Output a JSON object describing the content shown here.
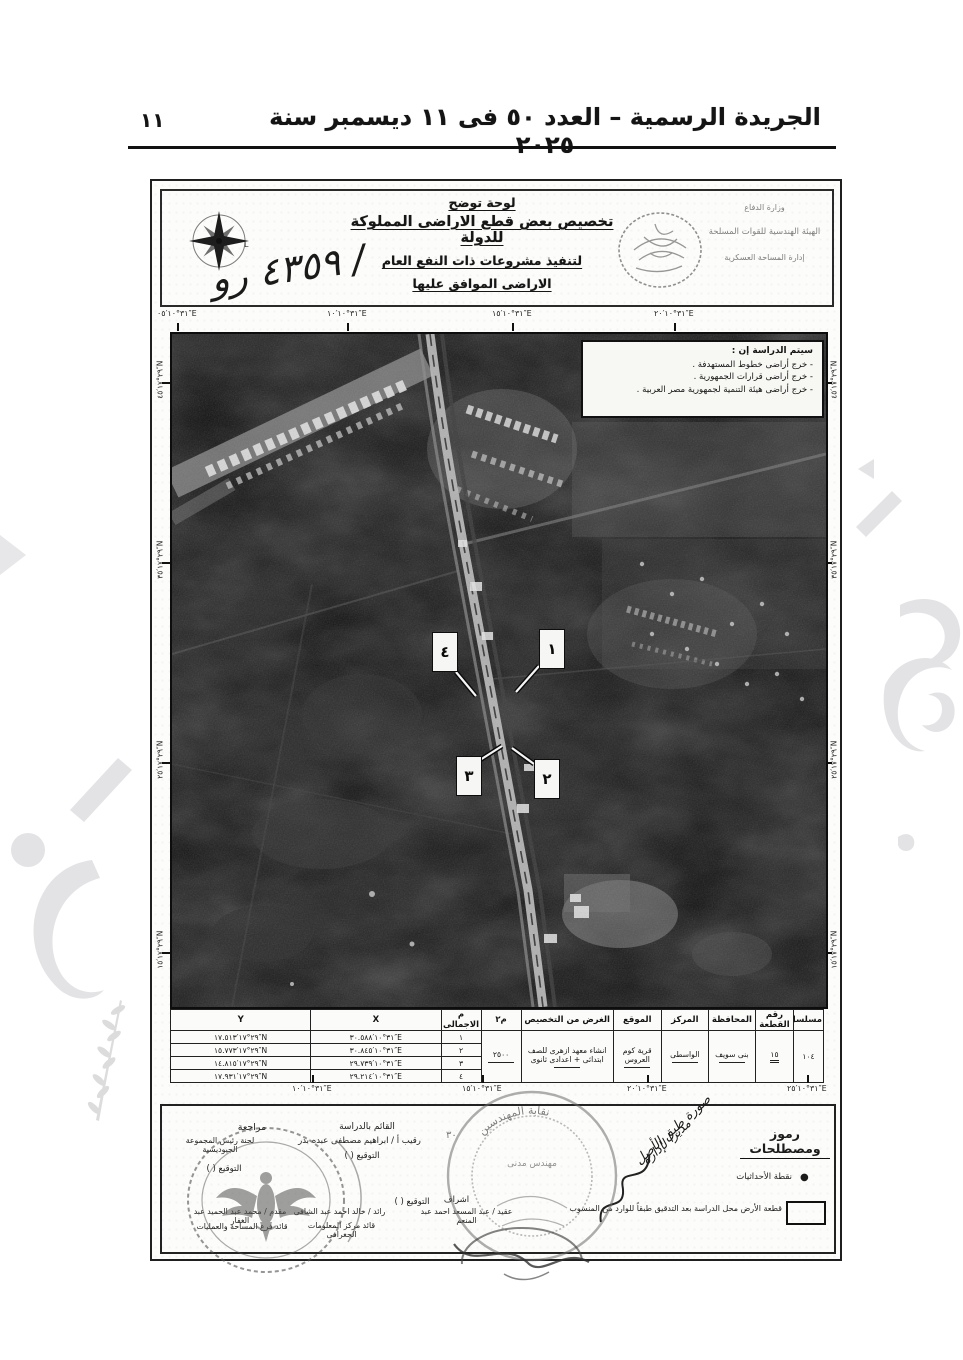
{
  "page": {
    "number": "١١",
    "header": "الجريدة الرسمية – العدد ٥٠ فى ١١ ديسمبر سنة ٢٠٢٥"
  },
  "plate": {
    "heading1": "لوحة توضح",
    "heading2": "تخصيص بعض قطع الاراضى المملوكة للدولة",
    "heading3": "لتنفيذ مشروعات ذات النفع العام",
    "heading4": "الاراضى الموافق عليها",
    "agency1": "وزارة الدفاع",
    "agency2": "الهيئة الهندسية للقوات المسلحة",
    "agency3": "إدارة المساحة العسكرية",
    "handwritten_number": "٤٣٥٩ رو /",
    "compass_letter": "L"
  },
  "map": {
    "legend_heading": "سيتم الدراسة إن :",
    "legend_item1": "- خرج أراضى خطوط المستهدفة .",
    "legend_item2": "- خرج أراضى قرارات الجمهورية .",
    "legend_item3": "- خرج أراضى هيئة التنمية لجمهورية مصر العربية .",
    "callout1": "١",
    "callout2": "٢",
    "callout3": "٣",
    "callout4": "٤",
    "coords_lon_top": [
      "٣١°١٠′٠٥″E",
      "٣١°١٠′١٠″E",
      "٣١°١٠′١٥″E",
      "٣١°١٠′٢٠″E"
    ],
    "coords_lon_bottom": [
      "٣١°١٠′١٠″E",
      "٣١°١٠′١٥″E",
      "٣١°١٠′٢٠″E",
      "٣١°١٠′٢٥″E"
    ],
    "coords_lat": [
      "٢٩°١٧′٤٥″N",
      "٢٩°١٧′٣٥″N",
      "٢٩°١٧′٢٥″N",
      "٢٩°١٧′١٥″N"
    ]
  },
  "table": {
    "headers": [
      "مسلسل",
      "رقم القطعة",
      "المحافظة",
      "المركز",
      "الموقع",
      "الغرض من التخصيص",
      "م٢",
      "م الاجمالى",
      "X",
      "Y"
    ],
    "serial": "١٠٤",
    "plot_no": "١٥",
    "governorate": "بنى سويف",
    "center": "الواسطى",
    "location": "قرية كوم العروس",
    "purpose": "انشاء معهد ازهرى للصف ابتدائى + اعدادى ثانوى",
    "area_m2": "٢٥٠٠",
    "points": [
      {
        "no": "١",
        "x": "٣١°١٠′٣٠.٥٨٨″E",
        "y": "٢٩°١٧′١٧.٥١٣″N"
      },
      {
        "no": "٢",
        "x": "٣١°١٠′٣٠.٨٤٥″E",
        "y": "٢٩°١٧′١٥.٧٧٣″N"
      },
      {
        "no": "٣",
        "x": "٣١°١٠′٢٩.٧٣٩″E",
        "y": "٢٩°١٧′١٤.٨١٥″N"
      },
      {
        "no": "٤",
        "x": "٣١°١٠′٢٩.٢١٤″E",
        "y": "٢٩°١٧′١٧.٩٣١″N"
      }
    ]
  },
  "footer": {
    "symbols_heading": "رموز ومصطلحات",
    "symbol_point": "نقطة الأحداثيات",
    "symbol_point_marker": "●",
    "symbol_plot": "قطعة الأرض محل الدراسة بعد التدقيق طبقاً للوارد من المنسوب",
    "handwriting1": "صورة طبق الأصل",
    "handwriting2": "مديرا لإدارة",
    "study_label": "القائم بالدراسة",
    "study_name": "رقيب أ / ابراهيم مصطفى عبده بدر",
    "review_label": "مراجعة",
    "review_name": "لجنة رئيس المجموعة الجيوديسية",
    "signature_label": "التوقيع (        )",
    "supervision_label": "اشراف",
    "supervisor_name": "عقيد / عبد المسعد احمد عبد المنعم",
    "officer1_name": "رائد / خالد احمد عبد الشافى",
    "officer1_title": "قائد مركز المعلومات الجغرافى",
    "officer2_name": "مقدم / محمد عبد الحميد عبد الغفار",
    "officer2_title": "قائد فرع المساحة والعمليات",
    "stamp_center_text": "نقابة المهندسين",
    "stamp_center_sub": "مهندس مدنى",
    "stamp_number": "٣٠"
  }
}
